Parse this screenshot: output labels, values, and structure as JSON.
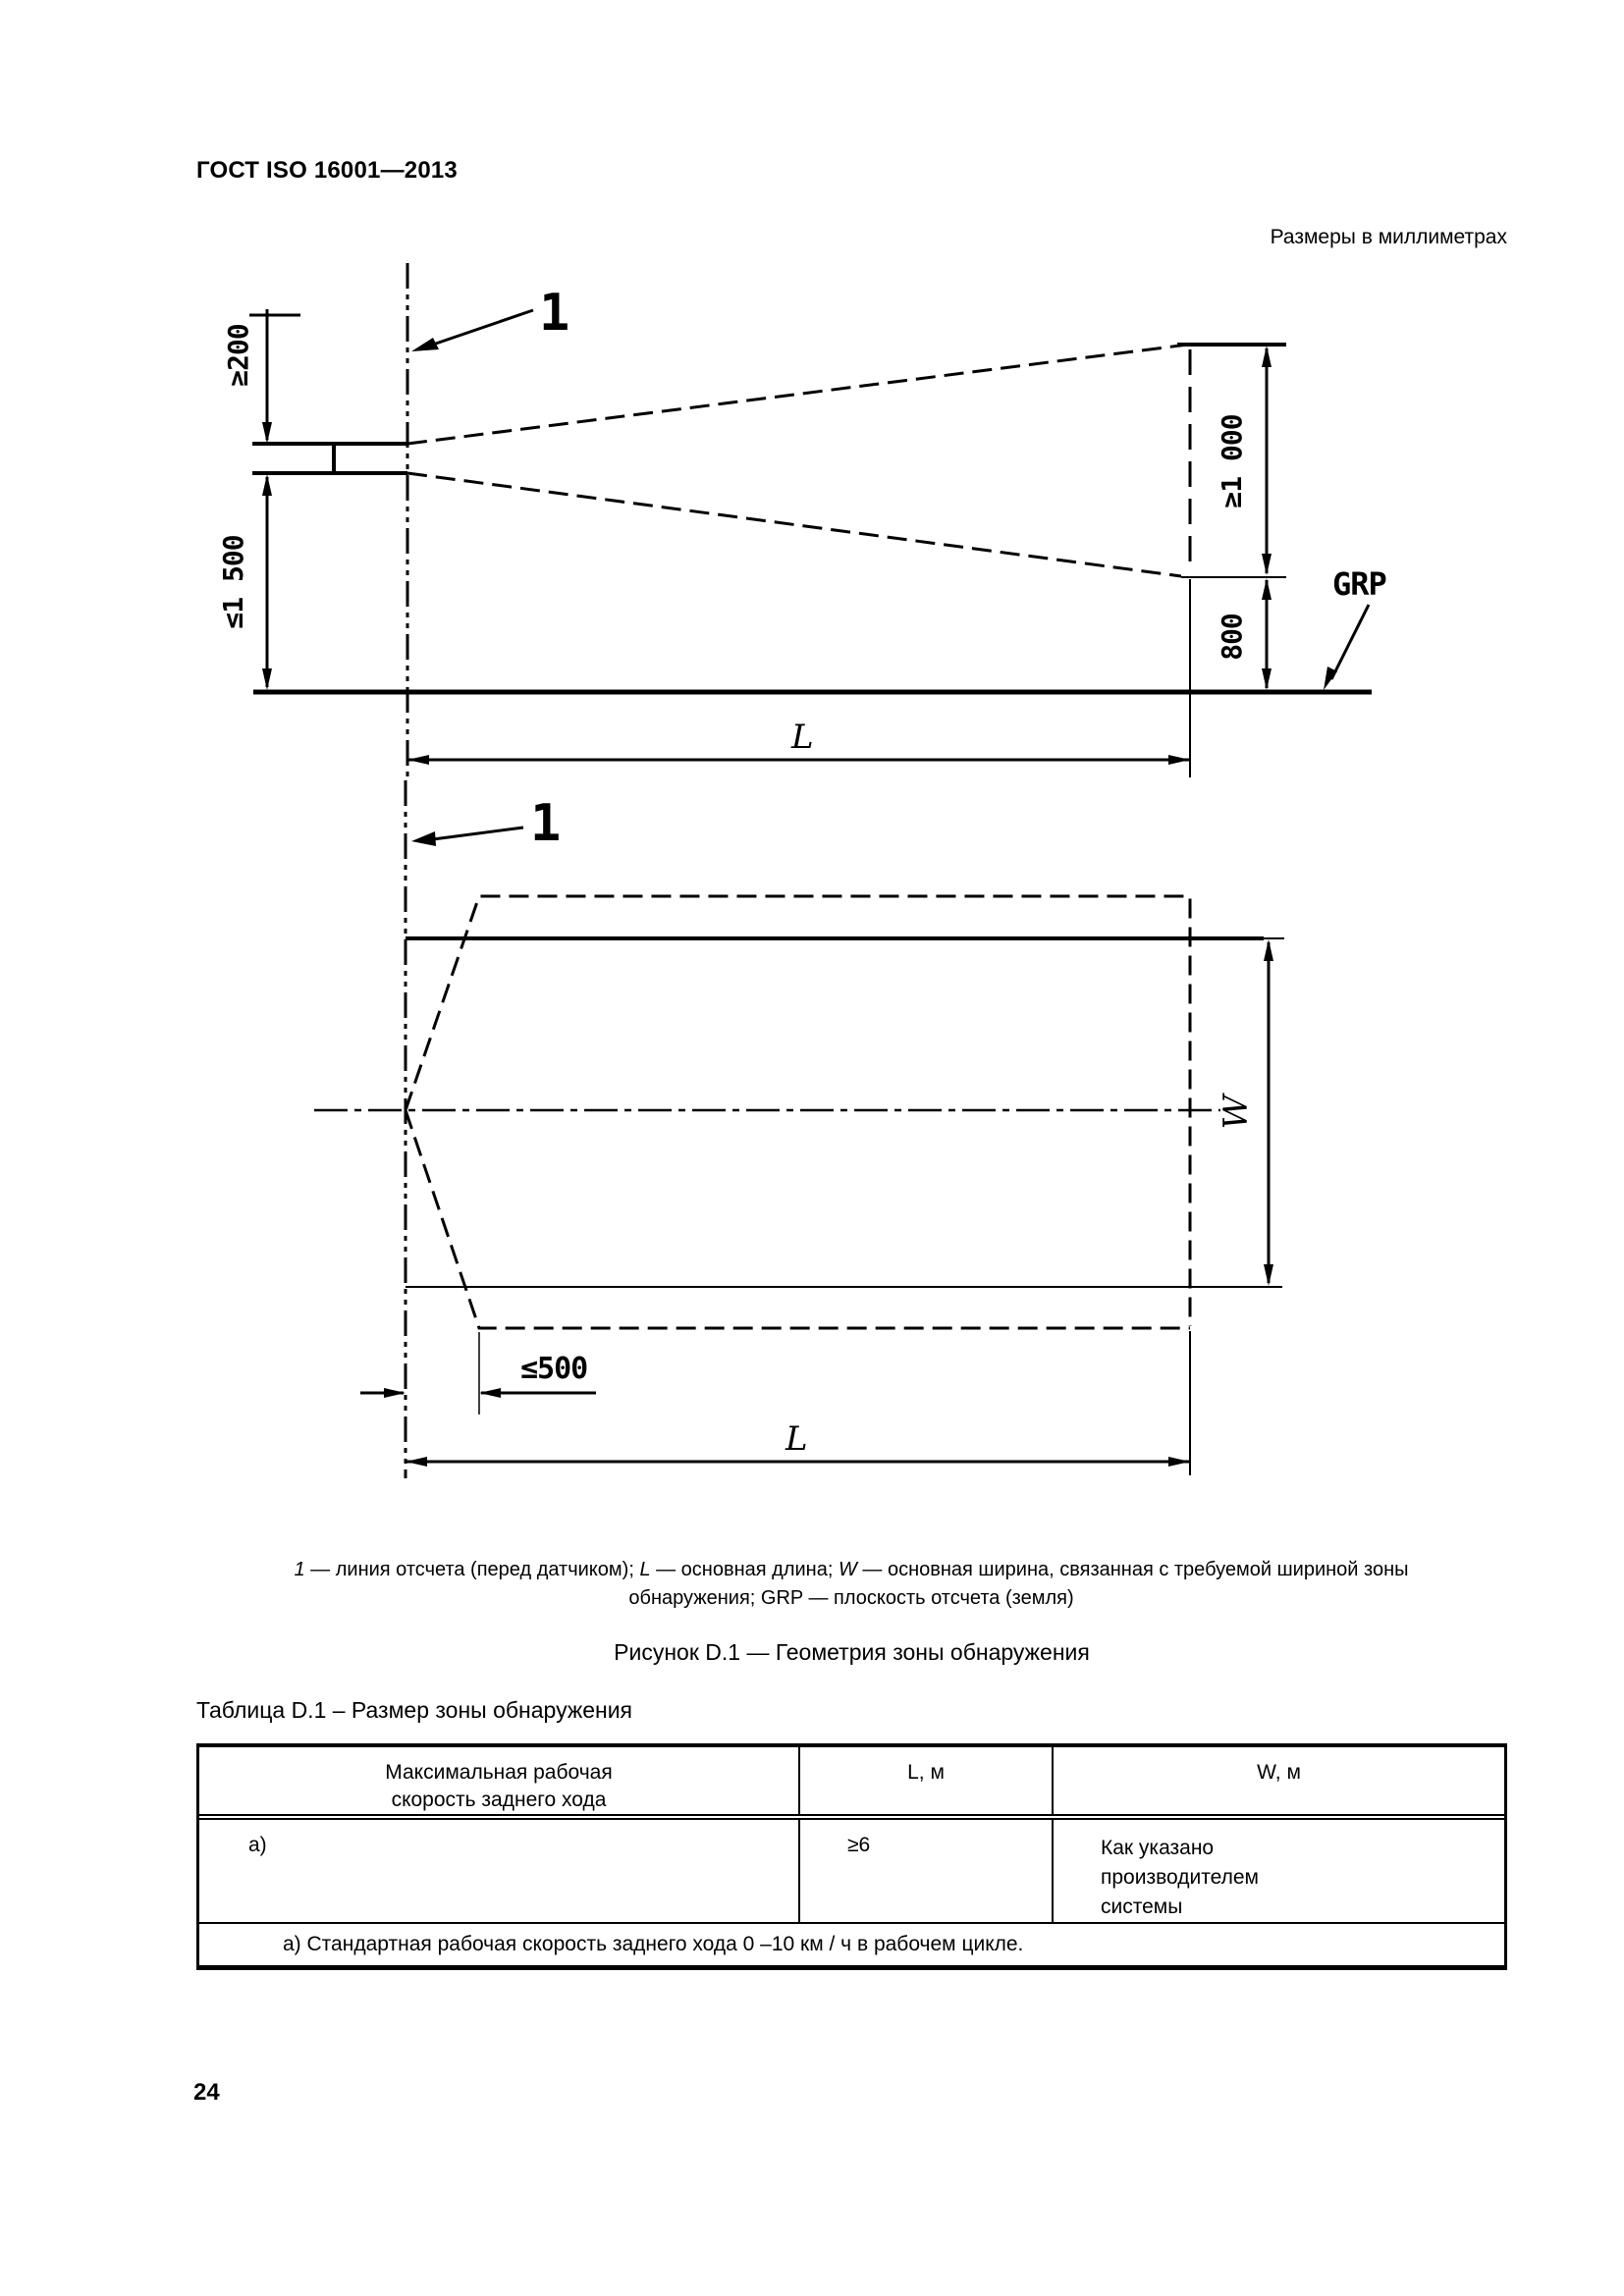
{
  "page": {
    "header_title": "ГОСТ ISO 16001—2013",
    "units_note": "Размеры в миллиметрах",
    "page_number": "24"
  },
  "figure": {
    "callout_label": "1",
    "dims": {
      "sensor_height": "≥200",
      "sensor_to_ground": "≤1 500",
      "zone_top_height": "≥1 000",
      "zone_rear_height": "800",
      "grp": "GRP",
      "length": "L",
      "width": "W",
      "lateral_offset": "≤500"
    },
    "caption": {
      "num": "1",
      "num_text": " — линия отсчета (перед датчиком); ",
      "l_sym": "L",
      "l_text": " — основная длина; ",
      "w_sym": "W",
      "w_text": " — основная ширина, связанная с требуемой шириной зоны",
      "line2": "обнаружения; GRP — плоскость отсчета (земля)"
    },
    "title": "Рисунок D.1 — Геометрия зоны обнаружения"
  },
  "table": {
    "title": "Таблица D.1 – Размер зоны обнаружения",
    "header": {
      "col1_line1": "Максимальная рабочая",
      "col1_line2": "скорость заднего хода",
      "col2": "L, м",
      "col3": "W, м"
    },
    "row": {
      "speed": "а)",
      "l_value": "≥6",
      "w_line1": "Как указано",
      "w_line2": "производителем",
      "w_line3": "системы"
    },
    "footnote": "а) Стандартная рабочая скорость заднего хода 0 –10 км / ч в рабочем цикле."
  }
}
